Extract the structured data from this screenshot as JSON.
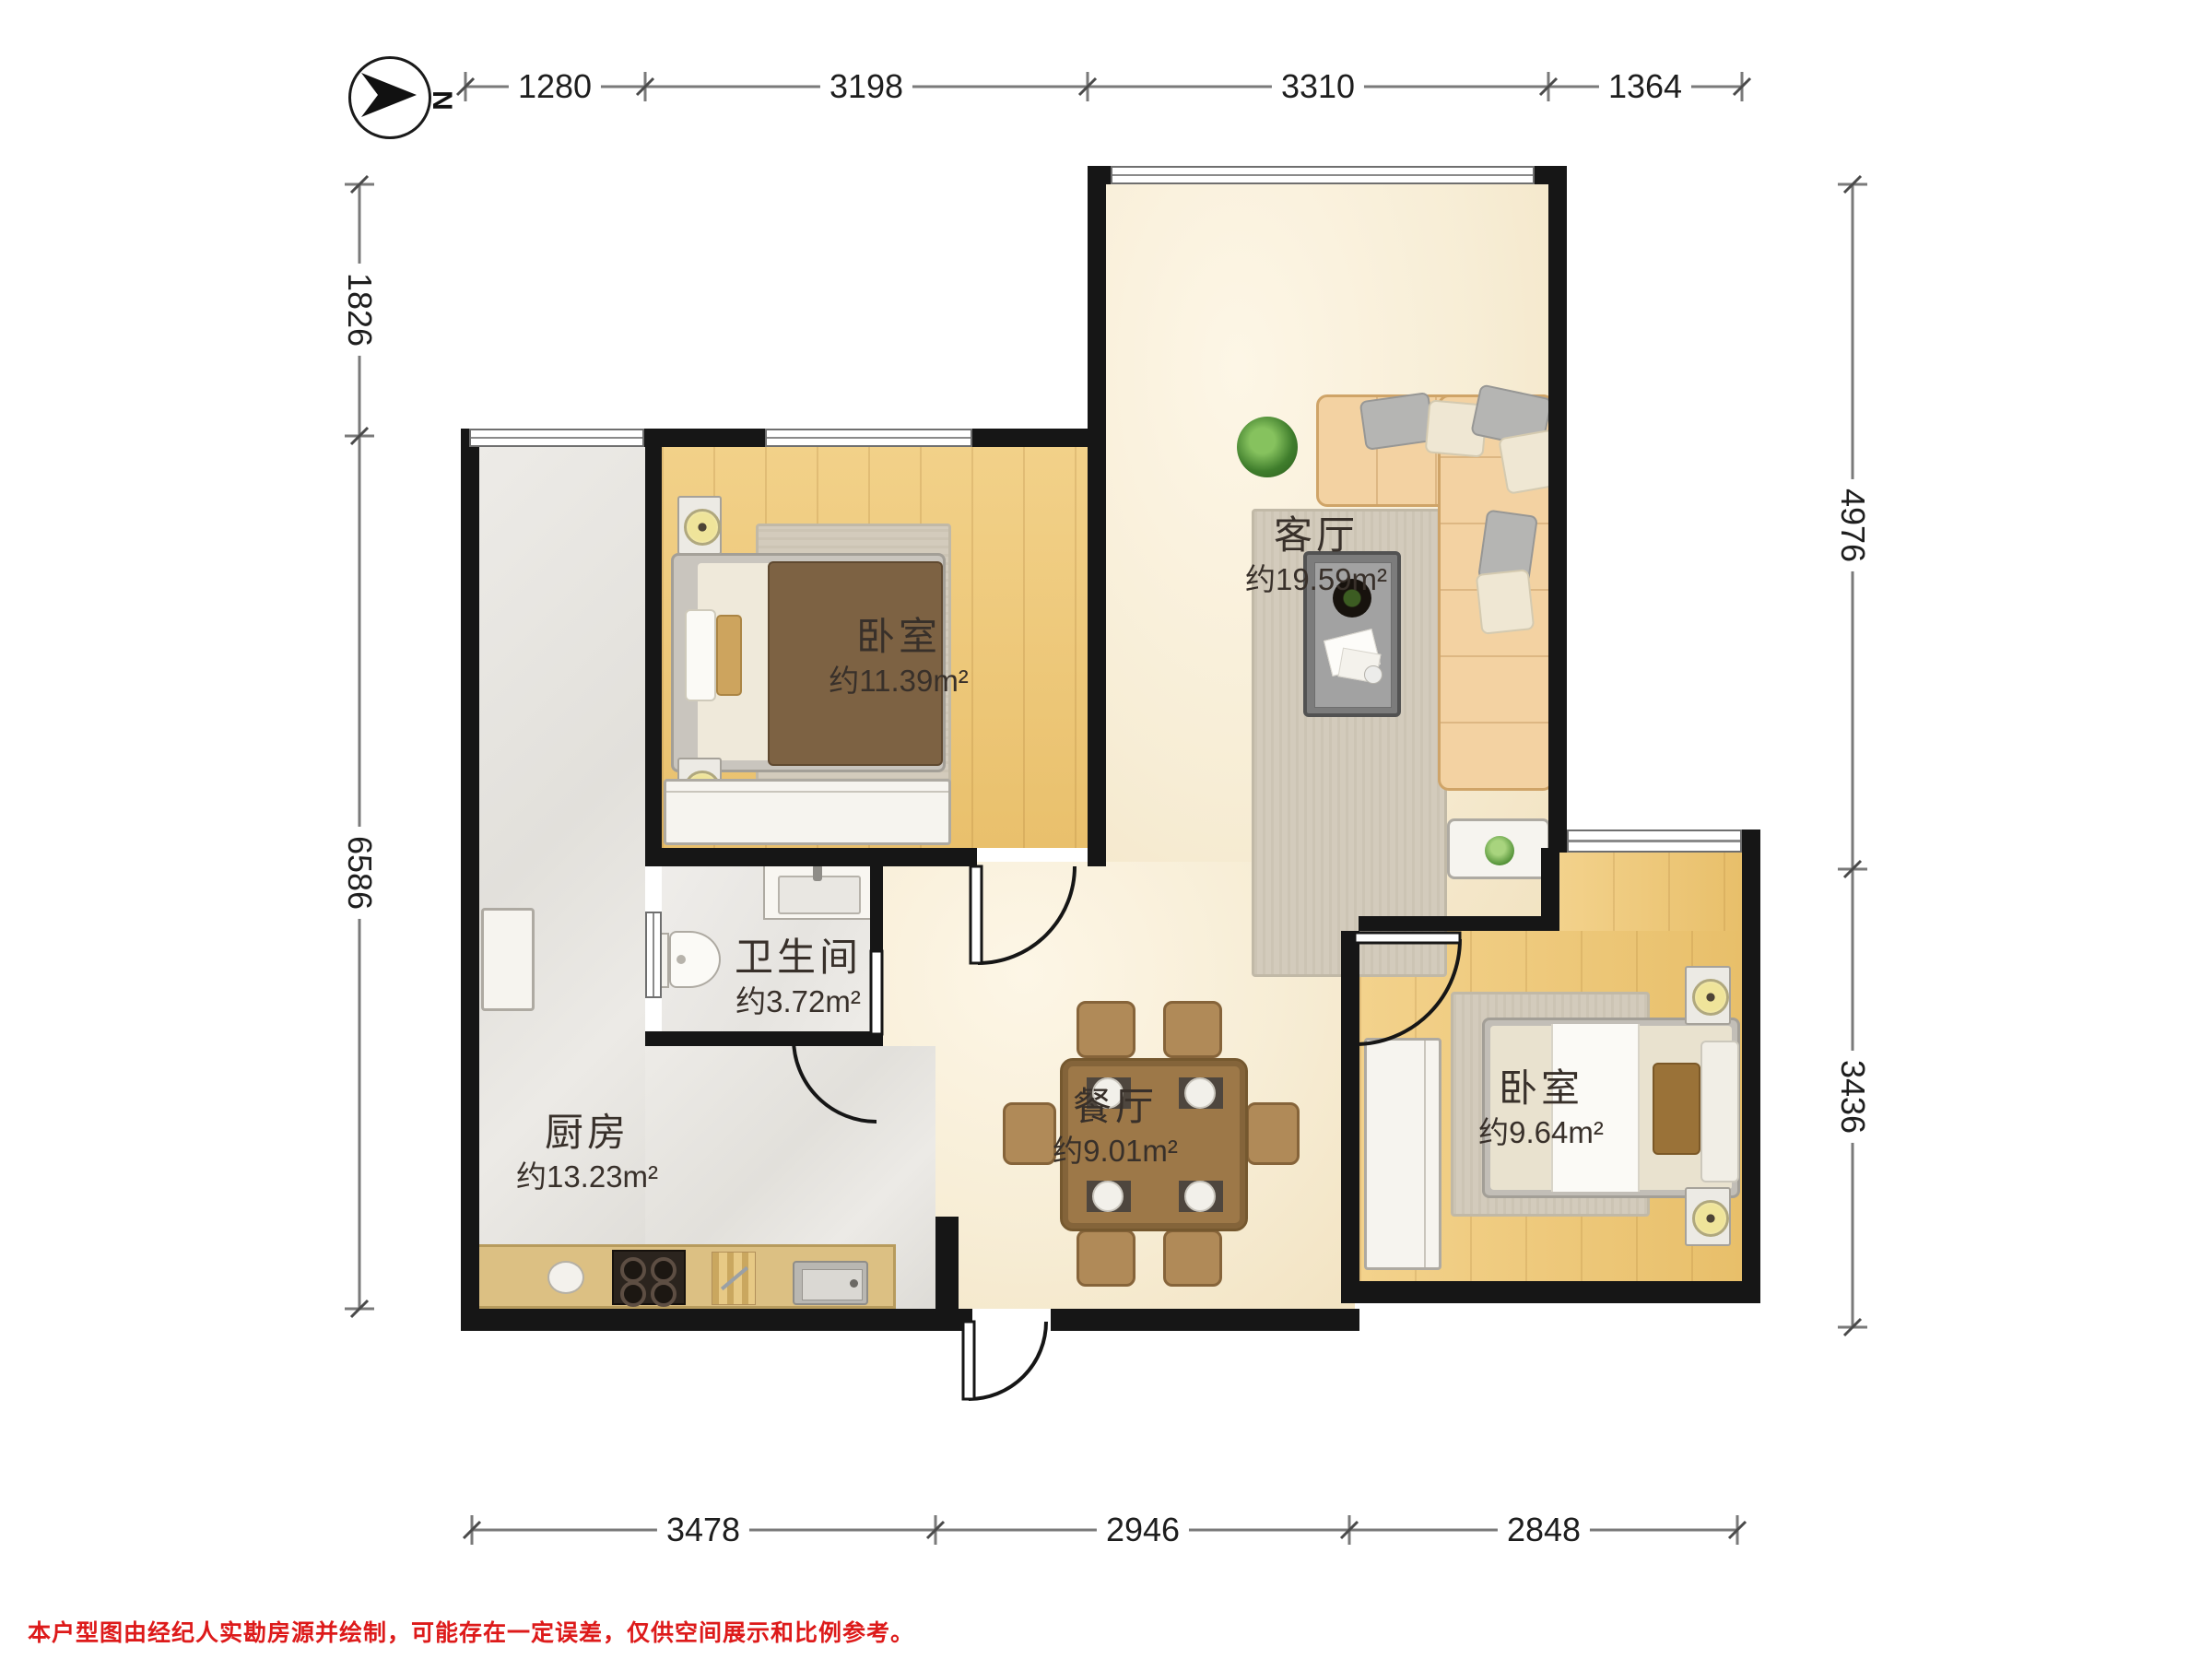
{
  "compass": {
    "north_label": "N"
  },
  "dimensions_mm": {
    "top": [
      "1280",
      "3198",
      "3310",
      "1364"
    ],
    "left": [
      "1826",
      "6586"
    ],
    "right": [
      "4976",
      "3436"
    ],
    "bottom": [
      "3478",
      "2946",
      "2848"
    ]
  },
  "rooms": {
    "bedroom_top": {
      "name": "卧室",
      "area": "约11.39m²"
    },
    "living_room": {
      "name": "客厅",
      "area": "约19.59m²"
    },
    "bathroom": {
      "name": "卫生间",
      "area": "约3.72m²"
    },
    "kitchen": {
      "name": "厨房",
      "area": "约13.23m²"
    },
    "dining_room": {
      "name": "餐厅",
      "area": "约9.01m²"
    },
    "bedroom_right": {
      "name": "卧室",
      "area": "约9.64m²"
    }
  },
  "disclaimer": {
    "text": "本户型图由经纪人实勘房源并绘制，可能存在一定误差，仅供空间展示和比例参考。"
  },
  "colors": {
    "wall": "#161616",
    "wood_floor": "#eec878",
    "marble_floor": "#f7edd5",
    "tile_floor": "#e6e4e0",
    "counter": "#dcc083",
    "sofa": "#f3d2a2",
    "table_wood": "#9d7848",
    "dimension_line": "#7a7a7a",
    "disclaimer_red": "#dd1a1a"
  }
}
